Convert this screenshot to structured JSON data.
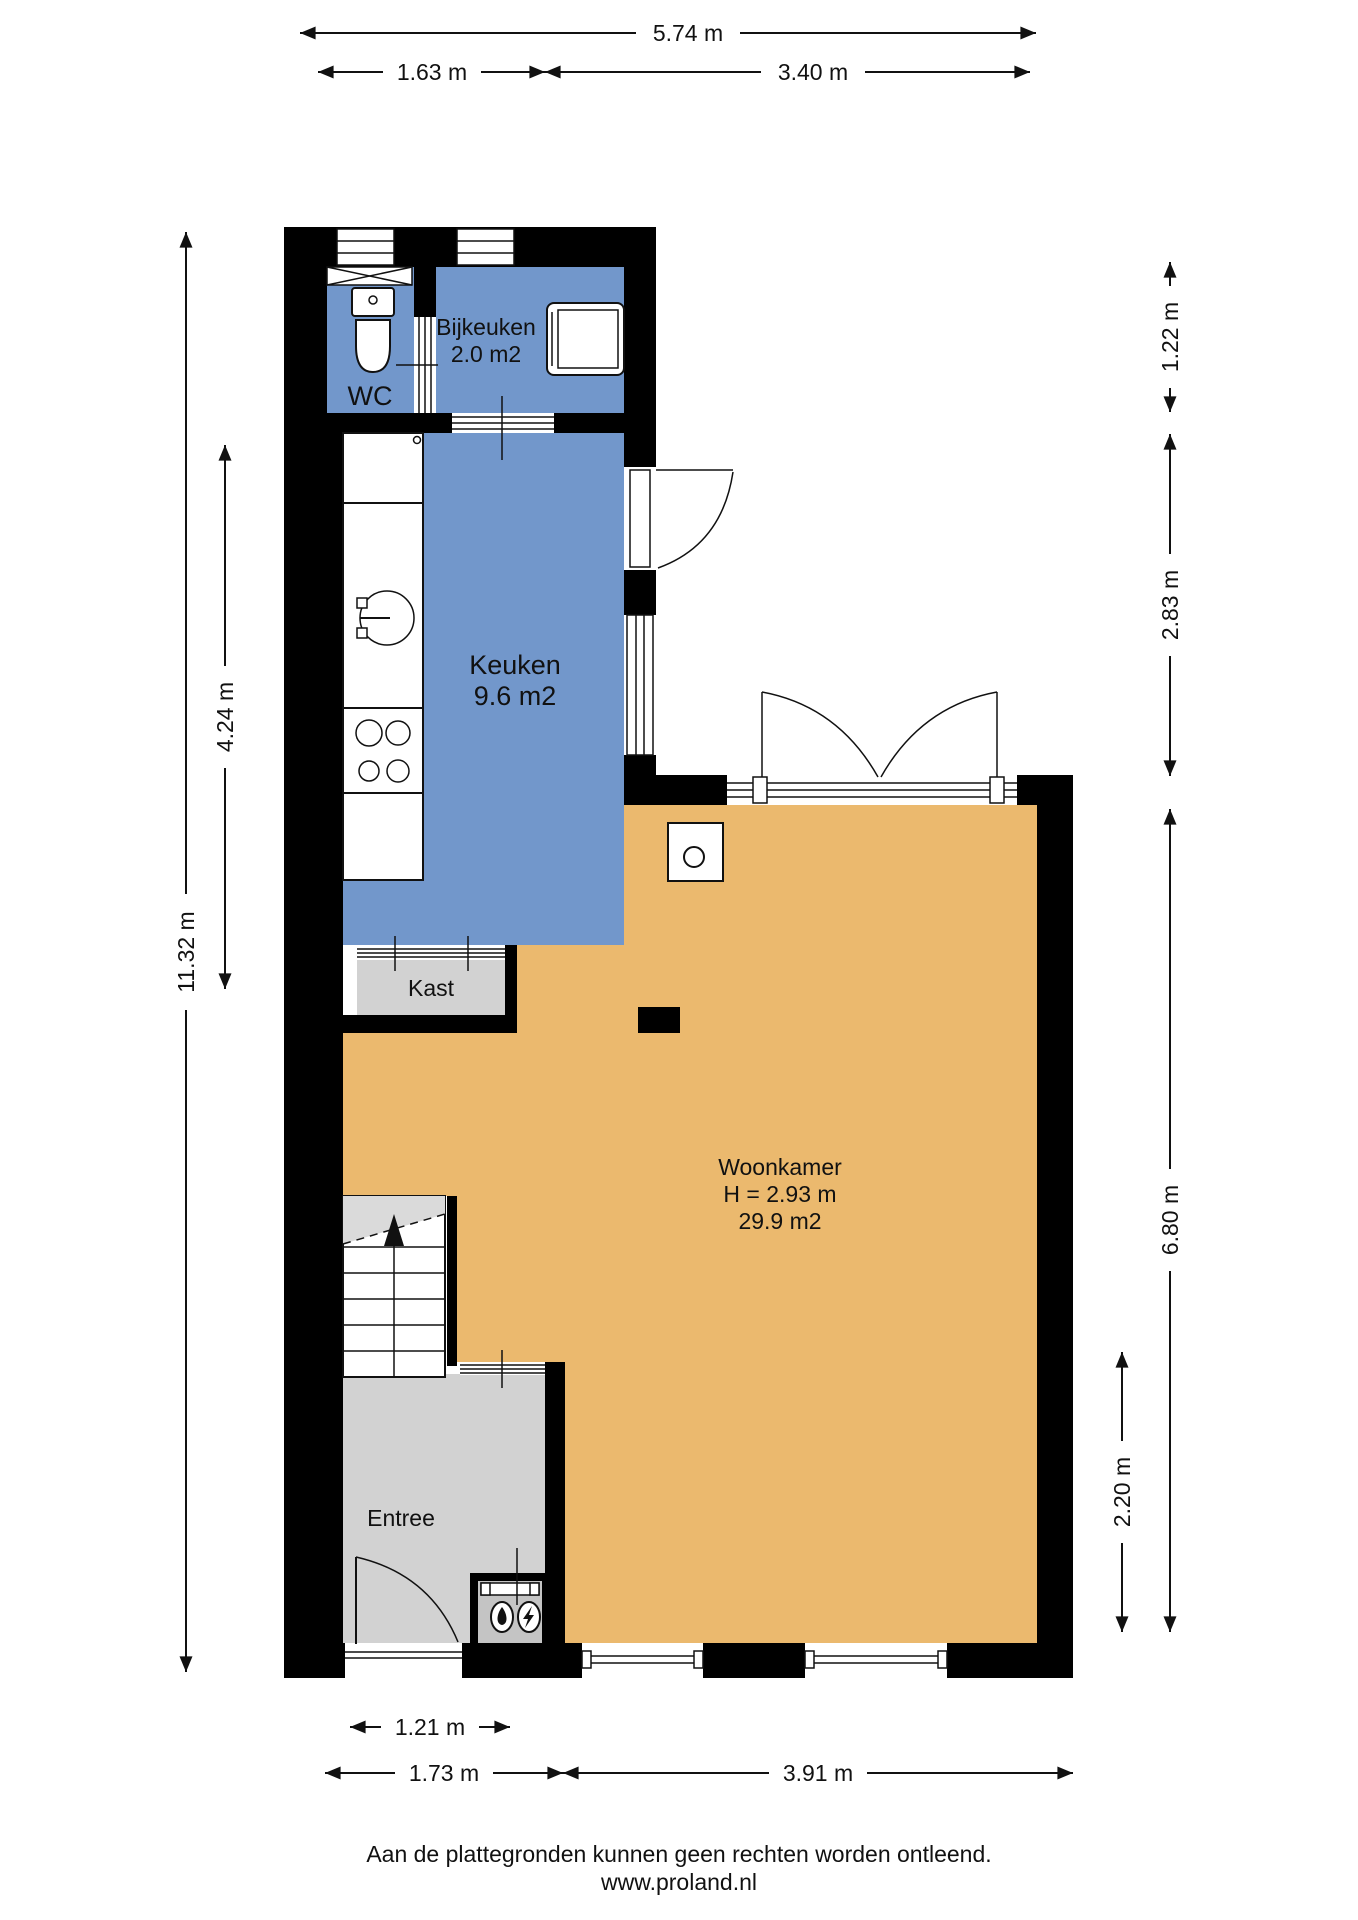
{
  "rooms": {
    "wc": {
      "label": "WC"
    },
    "bijkeuken": {
      "label": "Bijkeuken",
      "area": "2.0 m2"
    },
    "keuken": {
      "label": "Keuken",
      "area": "9.6 m2"
    },
    "kast": {
      "label": "Kast"
    },
    "woonkamer": {
      "label": "Woonkamer",
      "ceiling_height": "H = 2.93 m",
      "area": "29.9 m2"
    },
    "entree": {
      "label": "Entree"
    }
  },
  "dimensions": {
    "top_total": "5.74 m",
    "top_left_segment": "1.63 m",
    "top_right_segment": "3.40 m",
    "left_total": "11.32 m",
    "left_kitchen": "4.24 m",
    "right_utility": "1.22 m",
    "right_kitchen": "2.83 m",
    "right_living": "6.80 m",
    "right_lower": "2.20 m",
    "bottom_door": "1.21 m",
    "bottom_entree": "1.73 m",
    "bottom_living": "3.91 m"
  },
  "footer": {
    "disclaimer": "Aan de plattegronden kunnen geen rechten worden ontleend.",
    "website": "www.proland.nl"
  },
  "colors": {
    "wet_rooms": "#7297CB",
    "living": "#EBB96E",
    "circulation": "#D2D2D2",
    "walls": "#000000"
  },
  "fixtures": [
    "toilet",
    "mechanical-ventilation",
    "washing-machine",
    "sliding-door",
    "kitchen-sink",
    "stove-burners",
    "wood-stove",
    "stairs-up",
    "front-door",
    "water-meter",
    "electricity-meter"
  ]
}
